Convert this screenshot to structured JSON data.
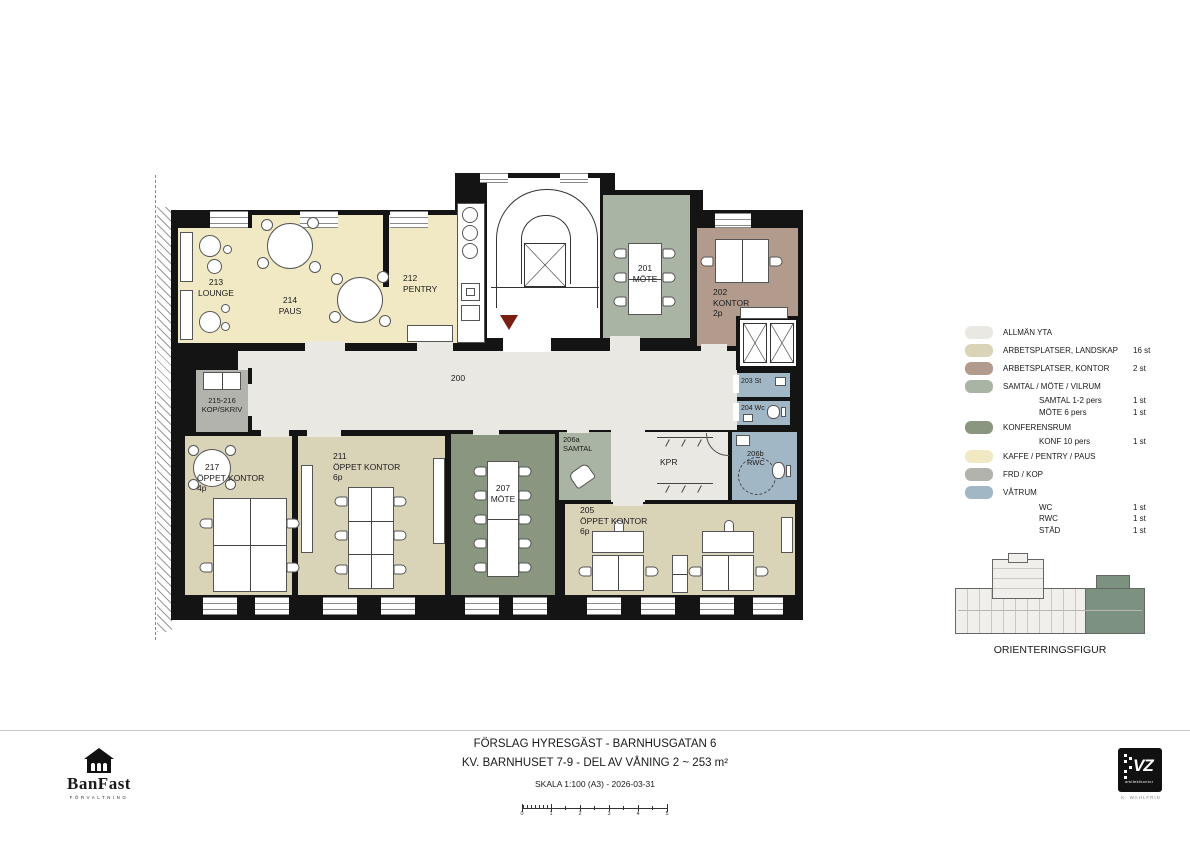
{
  "colors": {
    "wall": "#141414",
    "allman": "#e9e8e2",
    "landskap": "#d9d3b8",
    "kontor": "#b29b8d",
    "samtal": "#a9b4a4",
    "konferens": "#8a9680",
    "kaffe": "#f0e9c4",
    "frd": "#b3b3ad",
    "vatrum": "#a2b7c5",
    "entry_red": "#7a1d12",
    "orientation_green": "#7d9180"
  },
  "plan": {
    "rooms": {
      "r200": {
        "num": "200"
      },
      "r213": {
        "num": "213",
        "name": "LOUNGE"
      },
      "r214": {
        "num": "214",
        "name": "PAUS"
      },
      "r212": {
        "num": "212",
        "name": "PENTRY"
      },
      "r201": {
        "num": "201",
        "name": "MÖTE"
      },
      "r202": {
        "num": "202",
        "name": "KONTOR",
        "pers": "2p"
      },
      "r203": {
        "label": "203 St"
      },
      "r204": {
        "label": "204 Wc"
      },
      "r215": {
        "num": "215-216",
        "name": "KOP/SKRIV"
      },
      "r217": {
        "num": "217",
        "name": "ÖPPET KONTOR",
        "pers": "4p"
      },
      "r211": {
        "num": "211",
        "name": "ÖPPET KONTOR",
        "pers": "6p"
      },
      "r207": {
        "num": "207",
        "name": "MÖTE"
      },
      "r206a": {
        "num": "206a",
        "name": "SAMTAL"
      },
      "rkpr": {
        "label": "KPR"
      },
      "r206b": {
        "num": "206b",
        "name": "RWC"
      },
      "r205": {
        "num": "205",
        "name": "ÖPPET KONTOR",
        "pers": "6p"
      }
    }
  },
  "legend": {
    "items": [
      {
        "label": "ALLMÄN YTA",
        "color": "#e9e8e2",
        "count": ""
      },
      {
        "label": "ARBETSPLATSER, LANDSKAP",
        "color": "#d9d3b8",
        "count": "16 st"
      },
      {
        "label": "ARBETSPLATSER, KONTOR",
        "color": "#b29b8d",
        "count": "2 st"
      },
      {
        "label": "SAMTAL / MÖTE / VILRUM",
        "color": "#a9b4a4",
        "count": ""
      },
      {
        "label": "SAMTAL 1-2 pers",
        "count": "1 st"
      },
      {
        "label": "MÖTE 6 pers",
        "count": "1 st"
      },
      {
        "label": "KONFERENSRUM",
        "color": "#8a9680",
        "count": ""
      },
      {
        "label": "KONF 10 pers",
        "count": "1 st"
      },
      {
        "label": "KAFFE / PENTRY / PAUS",
        "color": "#f0e9c4",
        "count": ""
      },
      {
        "label": "FRD / KOP",
        "color": "#b3b3ad",
        "count": ""
      },
      {
        "label": "VÅTRUM",
        "color": "#a2b7c5",
        "count": ""
      },
      {
        "label": "WC",
        "count": "1 st"
      },
      {
        "label": "RWC",
        "count": "1 st"
      },
      {
        "label": "STÄD",
        "count": "1 st"
      }
    ]
  },
  "orientation": {
    "label": "ORIENTERINGSFIGUR"
  },
  "title": {
    "line1": "FÖRSLAG HYRESGÄST - BARNHUSGATAN 6",
    "line2": "KV. BARNHUSET 7-9 - DEL AV VÅNING 2 ~ 253 m²",
    "line3": "SKALA 1:100 (A3) - 2026-03-31",
    "scale_ticks": [
      "0",
      "1",
      "2",
      "3",
      "4",
      "5"
    ]
  },
  "logos": {
    "banfast": {
      "name": "BanFast",
      "sub": "FÖRVALTNING"
    },
    "vz": {
      "name": "VZ",
      "sub": "arkitektkontor",
      "person": "K. WAHLFRID"
    }
  }
}
